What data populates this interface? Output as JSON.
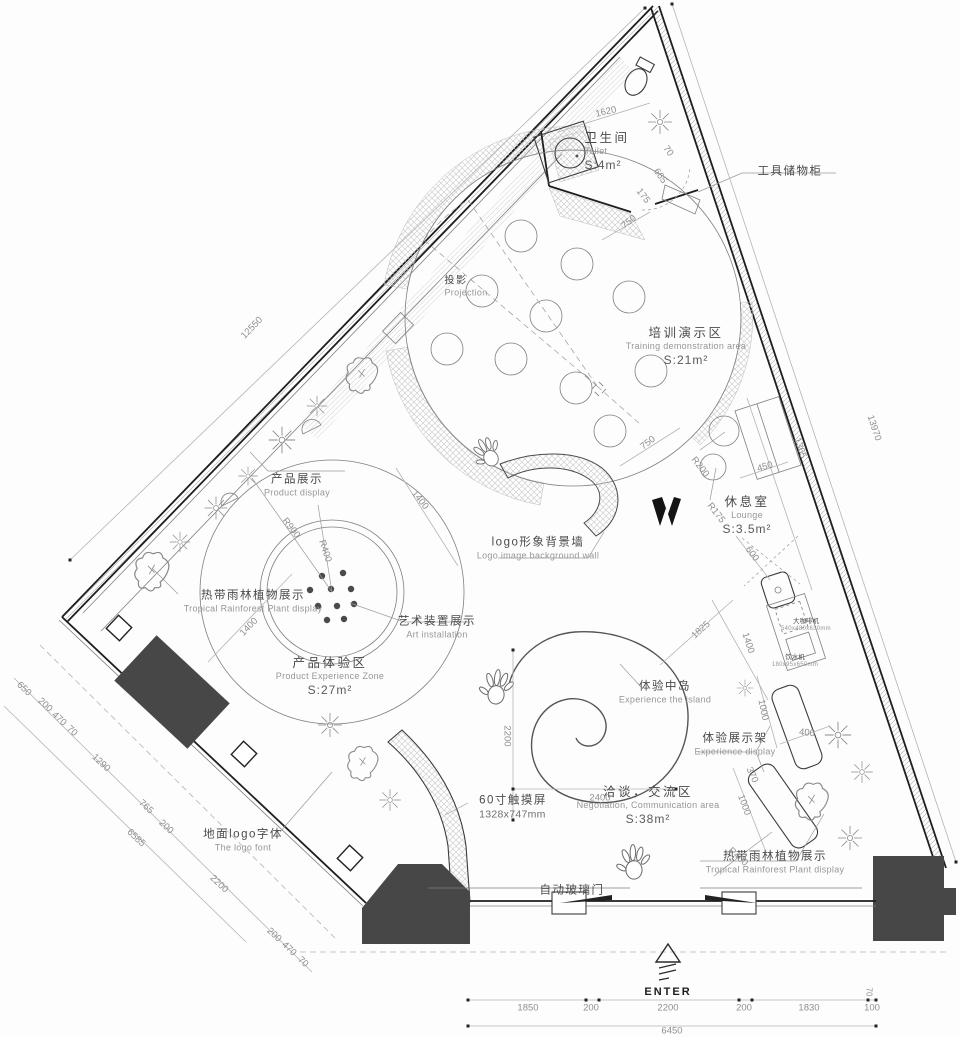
{
  "colors": {
    "wall": "#1e1e1e",
    "line": "#3c3c3c",
    "dim_line": "#b4b4b4",
    "dim_text": "#8f8f8f",
    "dark_fill": "#474747",
    "label_zh": "#4a4a4a",
    "label_en": "#969696",
    "bg": "#fdfdfd"
  },
  "areas": {
    "toilet": {
      "zh": "卫生间",
      "en": "Toilet",
      "area": "S:4m²"
    },
    "training": {
      "zh": "培训演示区",
      "en": "Training demonstration area",
      "area": "S:21m²"
    },
    "lounge": {
      "zh": "休息室",
      "en": "Lounge",
      "area": "S:3.5m²"
    },
    "product_experience": {
      "zh": "产品体验区",
      "en": "Product Experience Zone",
      "area": "S:27m²"
    },
    "negotiation": {
      "zh": "洽谈，交流区",
      "en": "Negotiation, Communication area",
      "area": "S:38m²"
    }
  },
  "labels": {
    "tool_cabinet": {
      "zh": "工具储物柜"
    },
    "projection": {
      "zh": "投影",
      "en": "Projection"
    },
    "product_display": {
      "zh": "产品展示",
      "en": "Product display"
    },
    "rainforest_left": {
      "zh": "热带雨林植物展示",
      "en": "Tropical Rainforest Plant display"
    },
    "art_installation": {
      "zh": "艺术装置展示",
      "en": "Art installation"
    },
    "logo_wall": {
      "zh": "logo形象背景墙",
      "en": "Logo image background wall"
    },
    "island": {
      "zh": "体验中岛",
      "en": "Experience the island"
    },
    "experience_display": {
      "zh": "体验展示架",
      "en": "Experience display"
    },
    "rainforest_right": {
      "zh": "热带雨林植物展示",
      "en": "Tropical Rainforest Plant display"
    },
    "touchscreen": {
      "zh": "60寸触摸屏",
      "en": "1328x747mm"
    },
    "floor_logo": {
      "zh": "地面logo字体",
      "en": "The logo font"
    },
    "auto_door": {
      "zh": "自动玻璃门"
    },
    "coffee_machine": {
      "zh": "大咖啡机",
      "en": "540x480x630mm"
    },
    "water_dispenser": {
      "zh": "饮水机",
      "en": "180x95x650mm"
    }
  },
  "entrance": {
    "label": "ENTER"
  },
  "dimensions": {
    "d12550": "12550",
    "d13970": "13970",
    "d1365": "1365",
    "d1620": "1620",
    "d750_toilet": "750",
    "d175_toilet": "175",
    "d665_toilet": "665",
    "d70_toilet": "70",
    "d750_lounge": "750",
    "dr200": "R200",
    "d450": "450",
    "dr175": "R175",
    "d600": "600",
    "d1825": "1825",
    "d1400_counter": "1400",
    "d1400_upper": "1400",
    "d1400_lower": "1400",
    "dr900": "R900",
    "dr400_art": "R400",
    "d2200_island": "2200",
    "d2400": "2400",
    "d1000_upper": "1000",
    "d400": "400",
    "d370": "370",
    "d1000_lower": "1000",
    "dr400_bench": "R400",
    "d650": "650",
    "d200_a": "200",
    "d470_a": "470",
    "d70_a": "70",
    "d1290": "1290",
    "d765": "765",
    "d200_b": "200",
    "d6585": "6585",
    "d2200_left": "2200",
    "d200_c": "200",
    "d470_b": "470",
    "d70_b": "70",
    "d1850": "1850",
    "d200_d": "200",
    "d2200_front": "2200",
    "d200_e": "200",
    "d1830": "1830",
    "d100": "100",
    "d70_front": "70",
    "d6450": "6450"
  }
}
